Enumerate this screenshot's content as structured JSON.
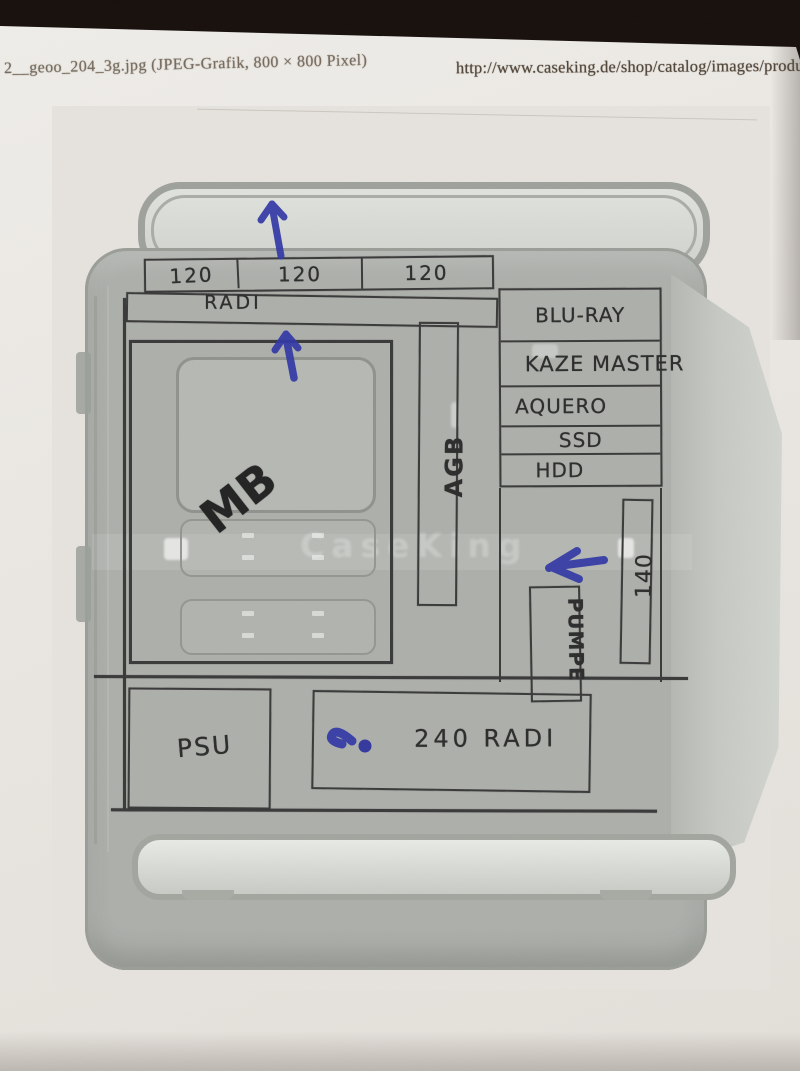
{
  "printout": {
    "filename": "2__geoo_204_3g.jpg (JPEG-Grafik, 800 × 800 Pixel)",
    "url": "http://www.caseking.de/shop/catalog/images/produ",
    "watermark": "CaseKing"
  },
  "plan": {
    "top_fans": [
      "120",
      "120",
      "120"
    ],
    "top_radi": "RADI",
    "mb": "MB",
    "agb": "AGB",
    "bays": [
      "BLU-RAY",
      "KAZE MASTER",
      "AQUERO",
      "SSD",
      "HDD"
    ],
    "fan140": "140",
    "pumpe": "PUMPE",
    "psu": "PSU",
    "radi240": "240 RADI"
  },
  "colors": {
    "ink_blue": "#3238a6",
    "pencil": "#3a3a3a",
    "desk": "#241811",
    "paper": "#eae7e2",
    "case_gray": "#acafaa"
  }
}
